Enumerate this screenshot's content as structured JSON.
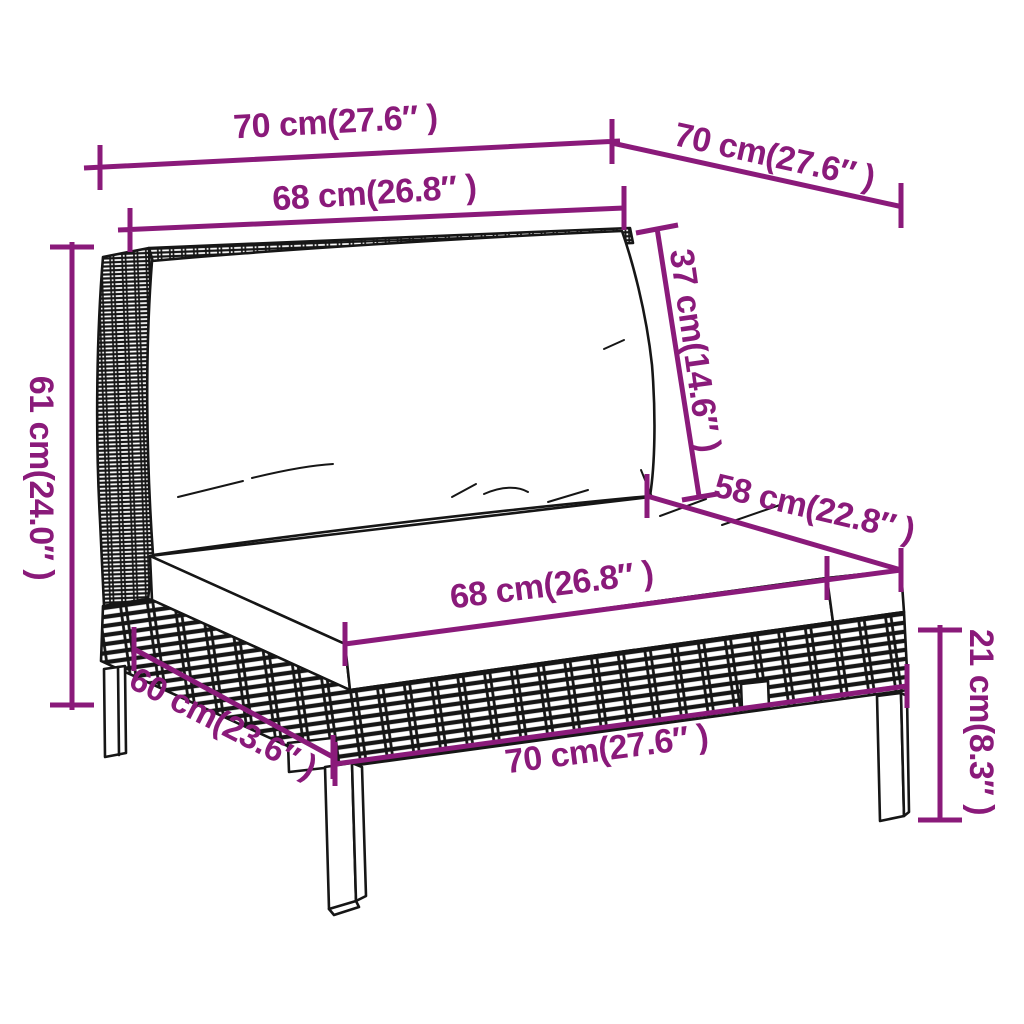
{
  "colors": {
    "dimension": "#8a1a7a",
    "outline": "#161616",
    "background": "#ffffff",
    "cushion": "#ffffff"
  },
  "dimensions": {
    "top_width": "70 cm(27.6″ )",
    "top_depth": "70 cm(27.6″ )",
    "back_width": "68 cm(26.8″ )",
    "back_cushion_height": "37 cm(14.6″ )",
    "total_height": "61 cm(24.0″ )",
    "seat_depth": "58 cm(22.8″ )",
    "seat_width": "68 cm(26.8″ )",
    "base_depth": "60 cm(23.6″ )",
    "base_width": "70 cm(27.6″ )",
    "leg_height": "21 cm(8.3″ )"
  }
}
